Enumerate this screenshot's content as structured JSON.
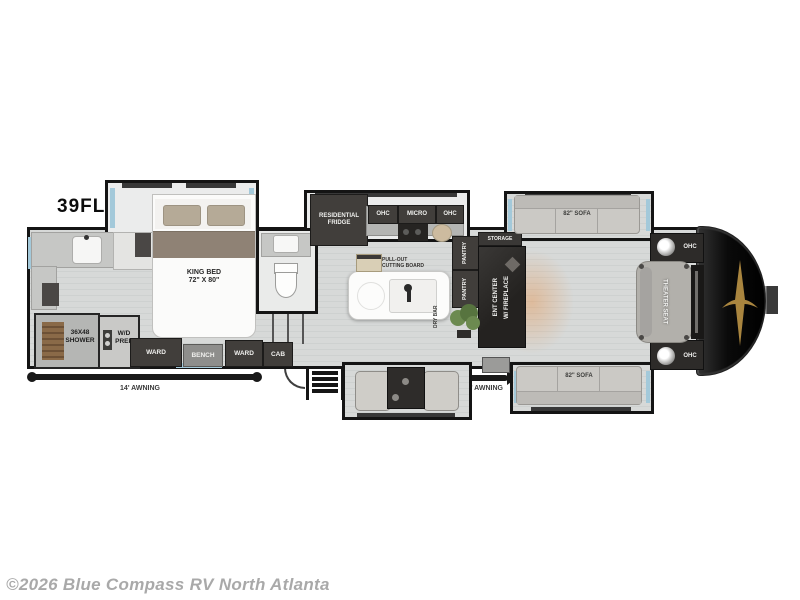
{
  "meta": {
    "model": "39FL",
    "copyright": "©2026 Blue Compass RV North Atlanta"
  },
  "colors": {
    "wall": "#141414",
    "floor": "#d7d9d8",
    "cabinet_dark": "#413e3b",
    "window_blue": "#a3c9da",
    "front_cap": "#0a0a0a",
    "emblem_gold": "#a9853f",
    "copyright_gray": "#a9a9a9"
  },
  "floorplan": {
    "rear_bath": {
      "shower": "36X48\nSHOWER",
      "wd_prep": "W/D\nPREP"
    },
    "bedroom": {
      "bed": "KING BED\n72\" X 80\"",
      "ward_left": "WARD",
      "bench": "BENCH",
      "ward_right": "WARD",
      "cab": "CAB"
    },
    "kitchen": {
      "fridge": "RESIDENTIAL\nFRIDGE",
      "ohc_left": "OHC",
      "micro": "MICRO",
      "ohc_right": "OHC",
      "cutting_board": "PULL-OUT\nCUTTING BOARD",
      "pantry_upper": "PANTRY",
      "pantry_lower": "PANTRY",
      "dry_bar": "DRY BAR"
    },
    "living": {
      "storage": "STORAGE",
      "ent_center_line1": "ENT CENTER",
      "ent_center_line2": "W/ FIREPLACE",
      "sofa_top": "82\" SOFA",
      "sofa_bottom": "82\" SOFA",
      "theater_seat": "THEATER SEAT",
      "ohc_front_top": "OHC",
      "ohc_front_bottom": "OHC"
    },
    "exterior": {
      "awning_left": "14' AWNING",
      "awning_right": "14' AWNING"
    }
  }
}
